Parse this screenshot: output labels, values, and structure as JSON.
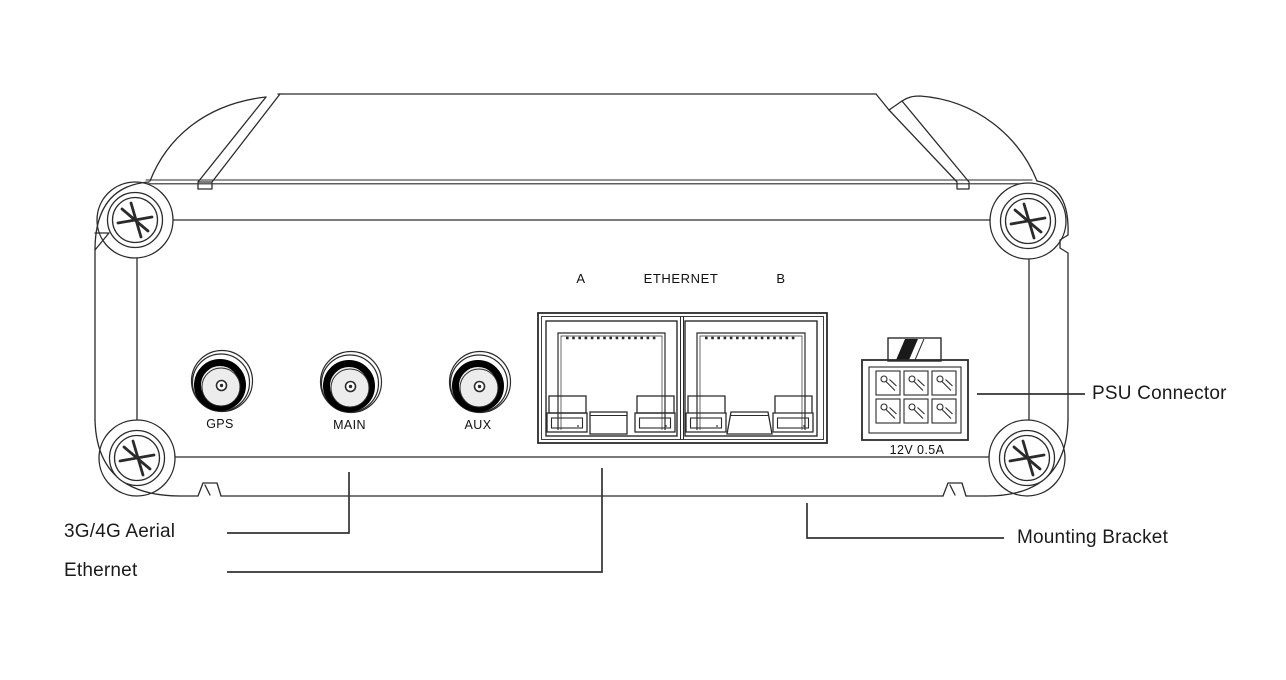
{
  "panel": {
    "port_a_label": "A",
    "ethernet_label": "ETHERNET",
    "port_b_label": "B",
    "gps_label": "GPS",
    "main_label": "MAIN",
    "aux_label": "AUX",
    "psu_rating_label": "12V 0.5A"
  },
  "callouts": {
    "aerial_label": "3G/4G Aerial",
    "ethernet_label": "Ethernet",
    "psu_label": "PSU Connector",
    "bracket_label": "Mounting Bracket"
  },
  "colors": {
    "line": "#2b2b2b",
    "leader_line": "#333333",
    "text": "#1b1b1b",
    "connector_face": "#ececec",
    "connector_ring": "#000000",
    "background": "#ffffff"
  }
}
